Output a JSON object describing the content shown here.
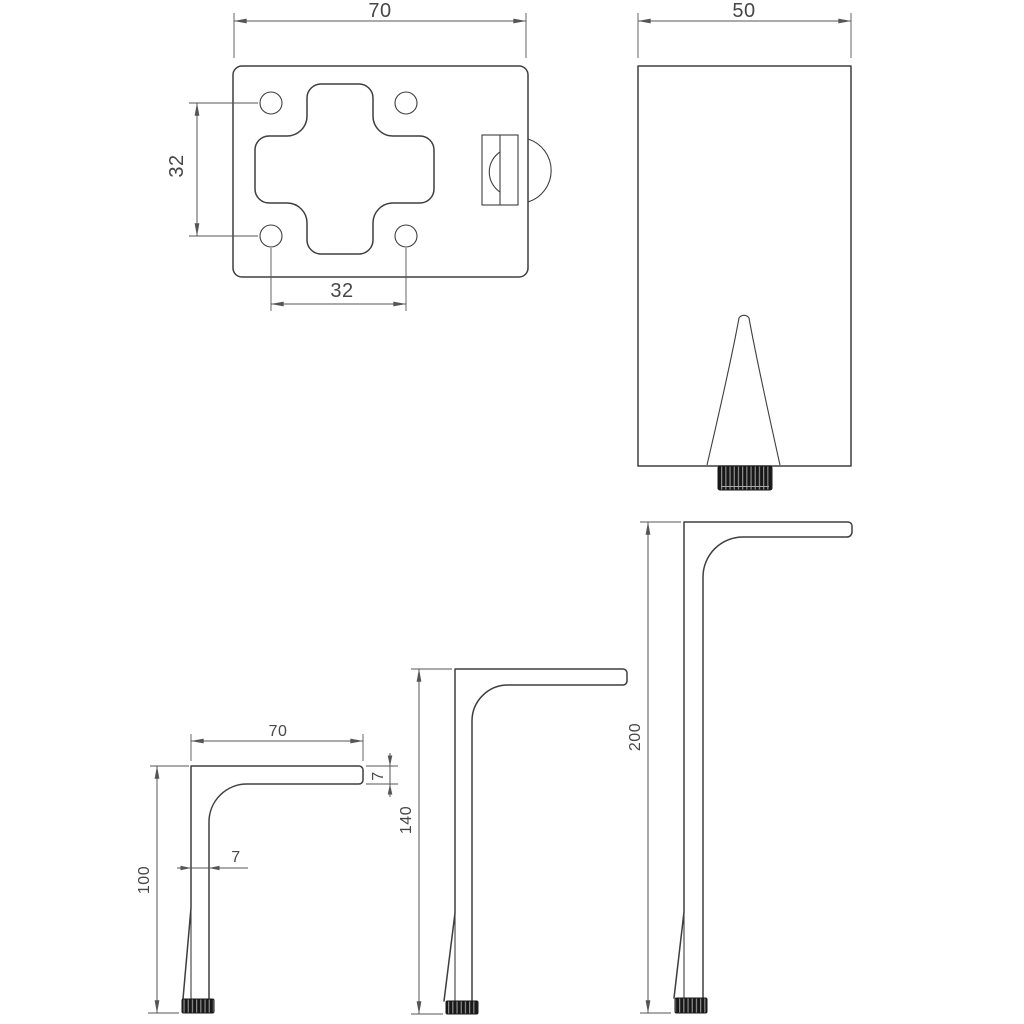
{
  "drawing": {
    "background": "#ffffff",
    "line_color": "#3e3e3e",
    "dimension_color": "#555555",
    "text_color": "#474747",
    "foot_color": "#181818",
    "views": {
      "plate_top": {
        "width": "70",
        "hole_pitch_vertical": "32",
        "hole_pitch_horizontal": "32"
      },
      "leg_front": {
        "width": "50"
      },
      "leg_100": {
        "arm_length": "70",
        "arm_thickness": "7",
        "post_thickness": "7",
        "height": "100"
      },
      "leg_140": {
        "height": "140"
      },
      "leg_200": {
        "height": "200"
      }
    }
  }
}
